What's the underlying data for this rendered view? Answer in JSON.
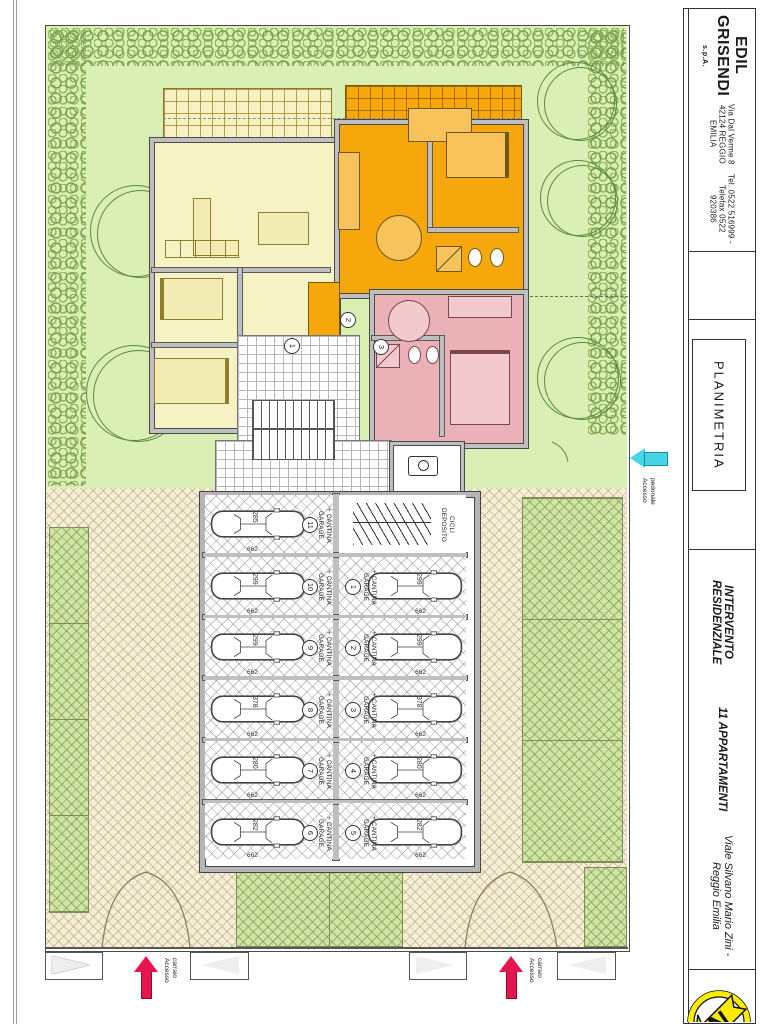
{
  "title_block": {
    "company_name": "EDIL GRISENDI",
    "company_suffix": "s.p.A.",
    "address": "Via Dal Verme 8   42124  REGGIO EMILIA",
    "phone": "Tel. 0522 516999 - Telefax 0522 920386",
    "drawing_title": "PLANIMETRIA",
    "project_title_line1": "INTERVENTO RESIDENZIALE",
    "project_title_line2": "11 APPARTAMENTI",
    "project_address": "Viale Silvano Mario Zini - Reggio Emilia",
    "north_letter": "N"
  },
  "plan": {
    "entrance_numbers": [
      "1",
      "2",
      "3"
    ],
    "garage_unit_label_line1": "GARAGE",
    "garage_unit_label_line2": "+ CANTINA",
    "bike_storage_line1": "DEPOSITO",
    "bike_storage_line2": "CICLI",
    "bay_length": "662",
    "garages_left": [
      {
        "number": "11",
        "car_size": "285"
      },
      {
        "number": "10",
        "car_size": "299"
      },
      {
        "number": "9",
        "car_size": "299"
      },
      {
        "number": "8",
        "car_size": "378"
      },
      {
        "number": "7",
        "car_size": "280"
      },
      {
        "number": "6",
        "car_size": "282"
      }
    ],
    "garages_right": [
      {
        "number": "1",
        "car_size": "299"
      },
      {
        "number": "2",
        "car_size": "299"
      },
      {
        "number": "3",
        "car_size": "378"
      },
      {
        "number": "4",
        "car_size": "280"
      },
      {
        "number": "5",
        "car_size": "282"
      }
    ],
    "access": {
      "vehicle_word1": "Accesso",
      "vehicle_word2": "carraio",
      "pedestrian_word1": "Accesso",
      "pedestrian_word2": "pedonale"
    }
  },
  "colors": {
    "apartment_yellow": "#f7f2c4",
    "apartment_orange": "#f6a70b",
    "apartment_pink": "#eab2b6",
    "garden_green": "#d9efb3",
    "paving_beige": "#f5efd8",
    "grass_paver_green": "#cfe4a5",
    "access_arrow_red": "#e5154e",
    "pedestrian_arrow_cyan": "#45d5e6",
    "north_logo_yellow": "#f9ec00"
  }
}
